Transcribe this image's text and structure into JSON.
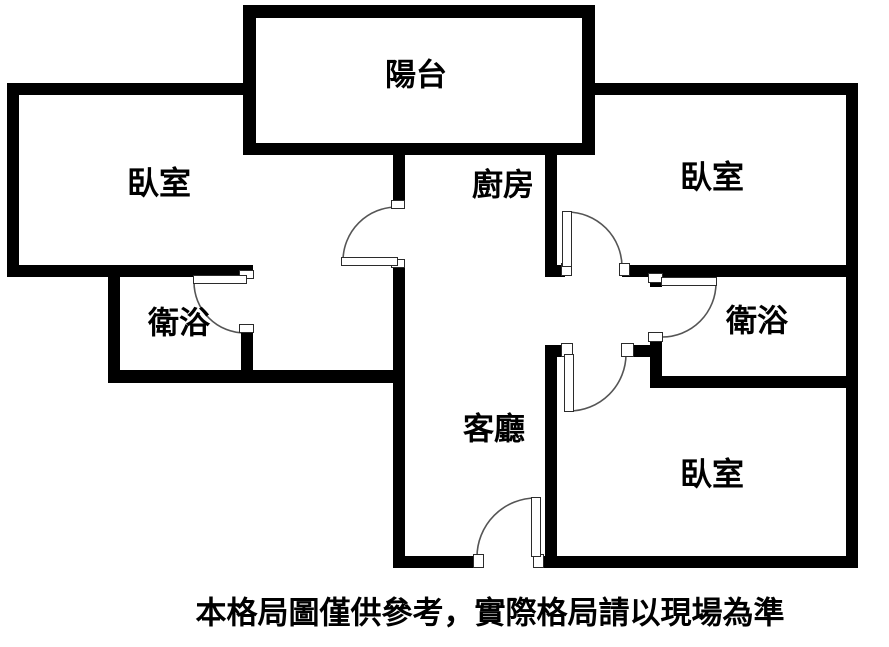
{
  "figure": {
    "type": "floor-plan",
    "caption": "本格局圖僅供參考，實際格局請以現場為準"
  },
  "rooms": [
    {
      "id": "balcony",
      "label": "陽台"
    },
    {
      "id": "bedroom-left",
      "label": "臥室"
    },
    {
      "id": "kitchen",
      "label": "廚房"
    },
    {
      "id": "bedroom-top-right",
      "label": "臥室"
    },
    {
      "id": "bathroom-left",
      "label": "衛浴"
    },
    {
      "id": "bathroom-right",
      "label": "衛浴"
    },
    {
      "id": "living-room",
      "label": "客廳"
    },
    {
      "id": "bedroom-bottom-right",
      "label": "臥室"
    }
  ],
  "colors": {
    "wall": "#000000",
    "background": "#ffffff",
    "door_line": "#555555",
    "text": "#000000"
  }
}
